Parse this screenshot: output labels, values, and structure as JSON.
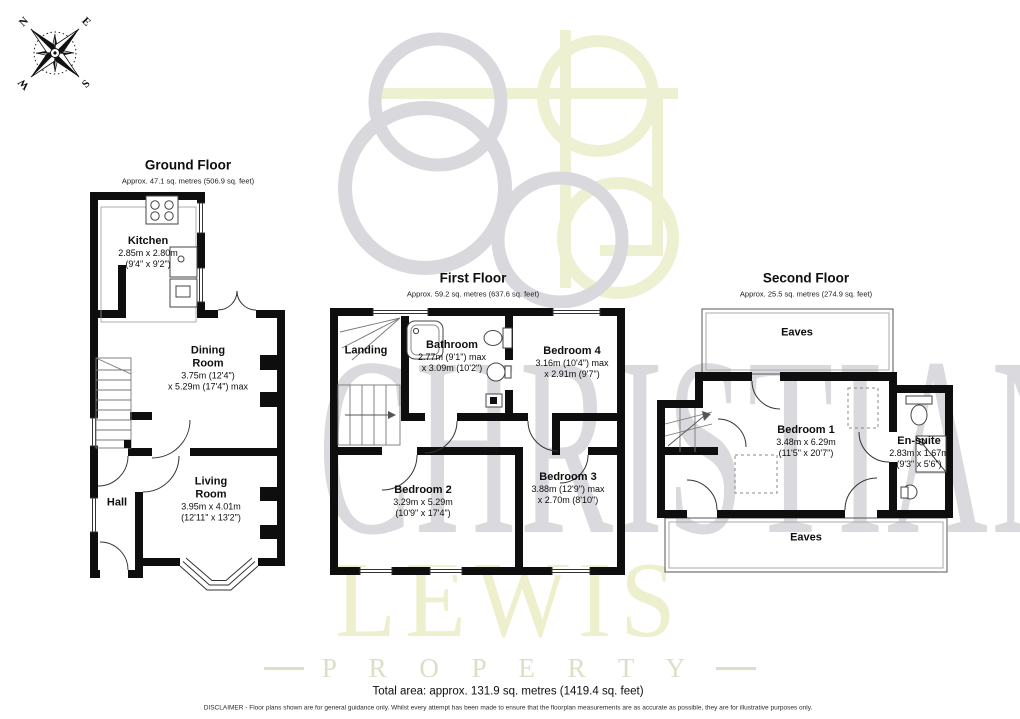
{
  "compass": {
    "north": "N",
    "east": "E",
    "south": "S",
    "west": "W"
  },
  "watermark": {
    "brand_top": "CHRISTIAN",
    "brand_bottom": "LEWIS",
    "brand_tag": "P R O P E R T Y"
  },
  "colors": {
    "wall": "#0e0e0e",
    "watermark_gray": "#d8d8dd",
    "watermark_yellow": "#eef0d2"
  },
  "floors": {
    "ground": {
      "title": "Ground Floor",
      "subtitle": "Approx. 47.1 sq. metres (506.9 sq. feet)",
      "kitchen": {
        "name": "Kitchen",
        "l1": "2.85m x 2.80m",
        "l2": "(9'4\" x 9'2\")"
      },
      "dining": {
        "name": "Dining Room",
        "l1": "3.75m (12'4\")",
        "l2": "x 5.29m (17'4\") max"
      },
      "living": {
        "name": "Living Room",
        "l1": "3.95m x 4.01m",
        "l2": "(12'11\" x 13'2\")"
      },
      "hall": {
        "name": "Hall"
      }
    },
    "first": {
      "title": "First Floor",
      "subtitle": "Approx. 59.2 sq. metres (637.6 sq. feet)",
      "landing": {
        "name": "Landing"
      },
      "bathroom": {
        "name": "Bathroom",
        "l1": "2.77m (9'1\") max",
        "l2": "x 3.09m (10'2\")"
      },
      "bedroom4": {
        "name": "Bedroom 4",
        "l1": "3.16m (10'4\") max",
        "l2": "x 2.91m (9'7\")"
      },
      "bedroom2": {
        "name": "Bedroom 2",
        "l1": "3.29m x 5.29m",
        "l2": "(10'9\" x 17'4\")"
      },
      "bedroom3": {
        "name": "Bedroom 3",
        "l1": "3.88m (12'9\") max",
        "l2": "x 2.70m (8'10\")"
      }
    },
    "second": {
      "title": "Second Floor",
      "subtitle": "Approx. 25.5 sq. metres (274.9 sq. feet)",
      "eaves_top": {
        "name": "Eaves"
      },
      "eaves_bottom": {
        "name": "Eaves"
      },
      "bedroom1": {
        "name": "Bedroom 1",
        "l1": "3.48m x 6.29m",
        "l2": "(11'5\" x 20'7\")"
      },
      "ensuite": {
        "name": "En-suite",
        "l1": "2.83m x 1.67m",
        "l2": "(9'3\" x 5'6\")"
      }
    }
  },
  "footer": {
    "total_area": "Total area: approx. 131.9 sq. metres (1419.4 sq. feet)",
    "disclaimer": "DISCLAIMER -  Floor plans shown are for general guidance only. Whilst every attempt has been made to ensure that the floorplan measurements are as accurate as possible, they are for illustrative purposes only."
  }
}
